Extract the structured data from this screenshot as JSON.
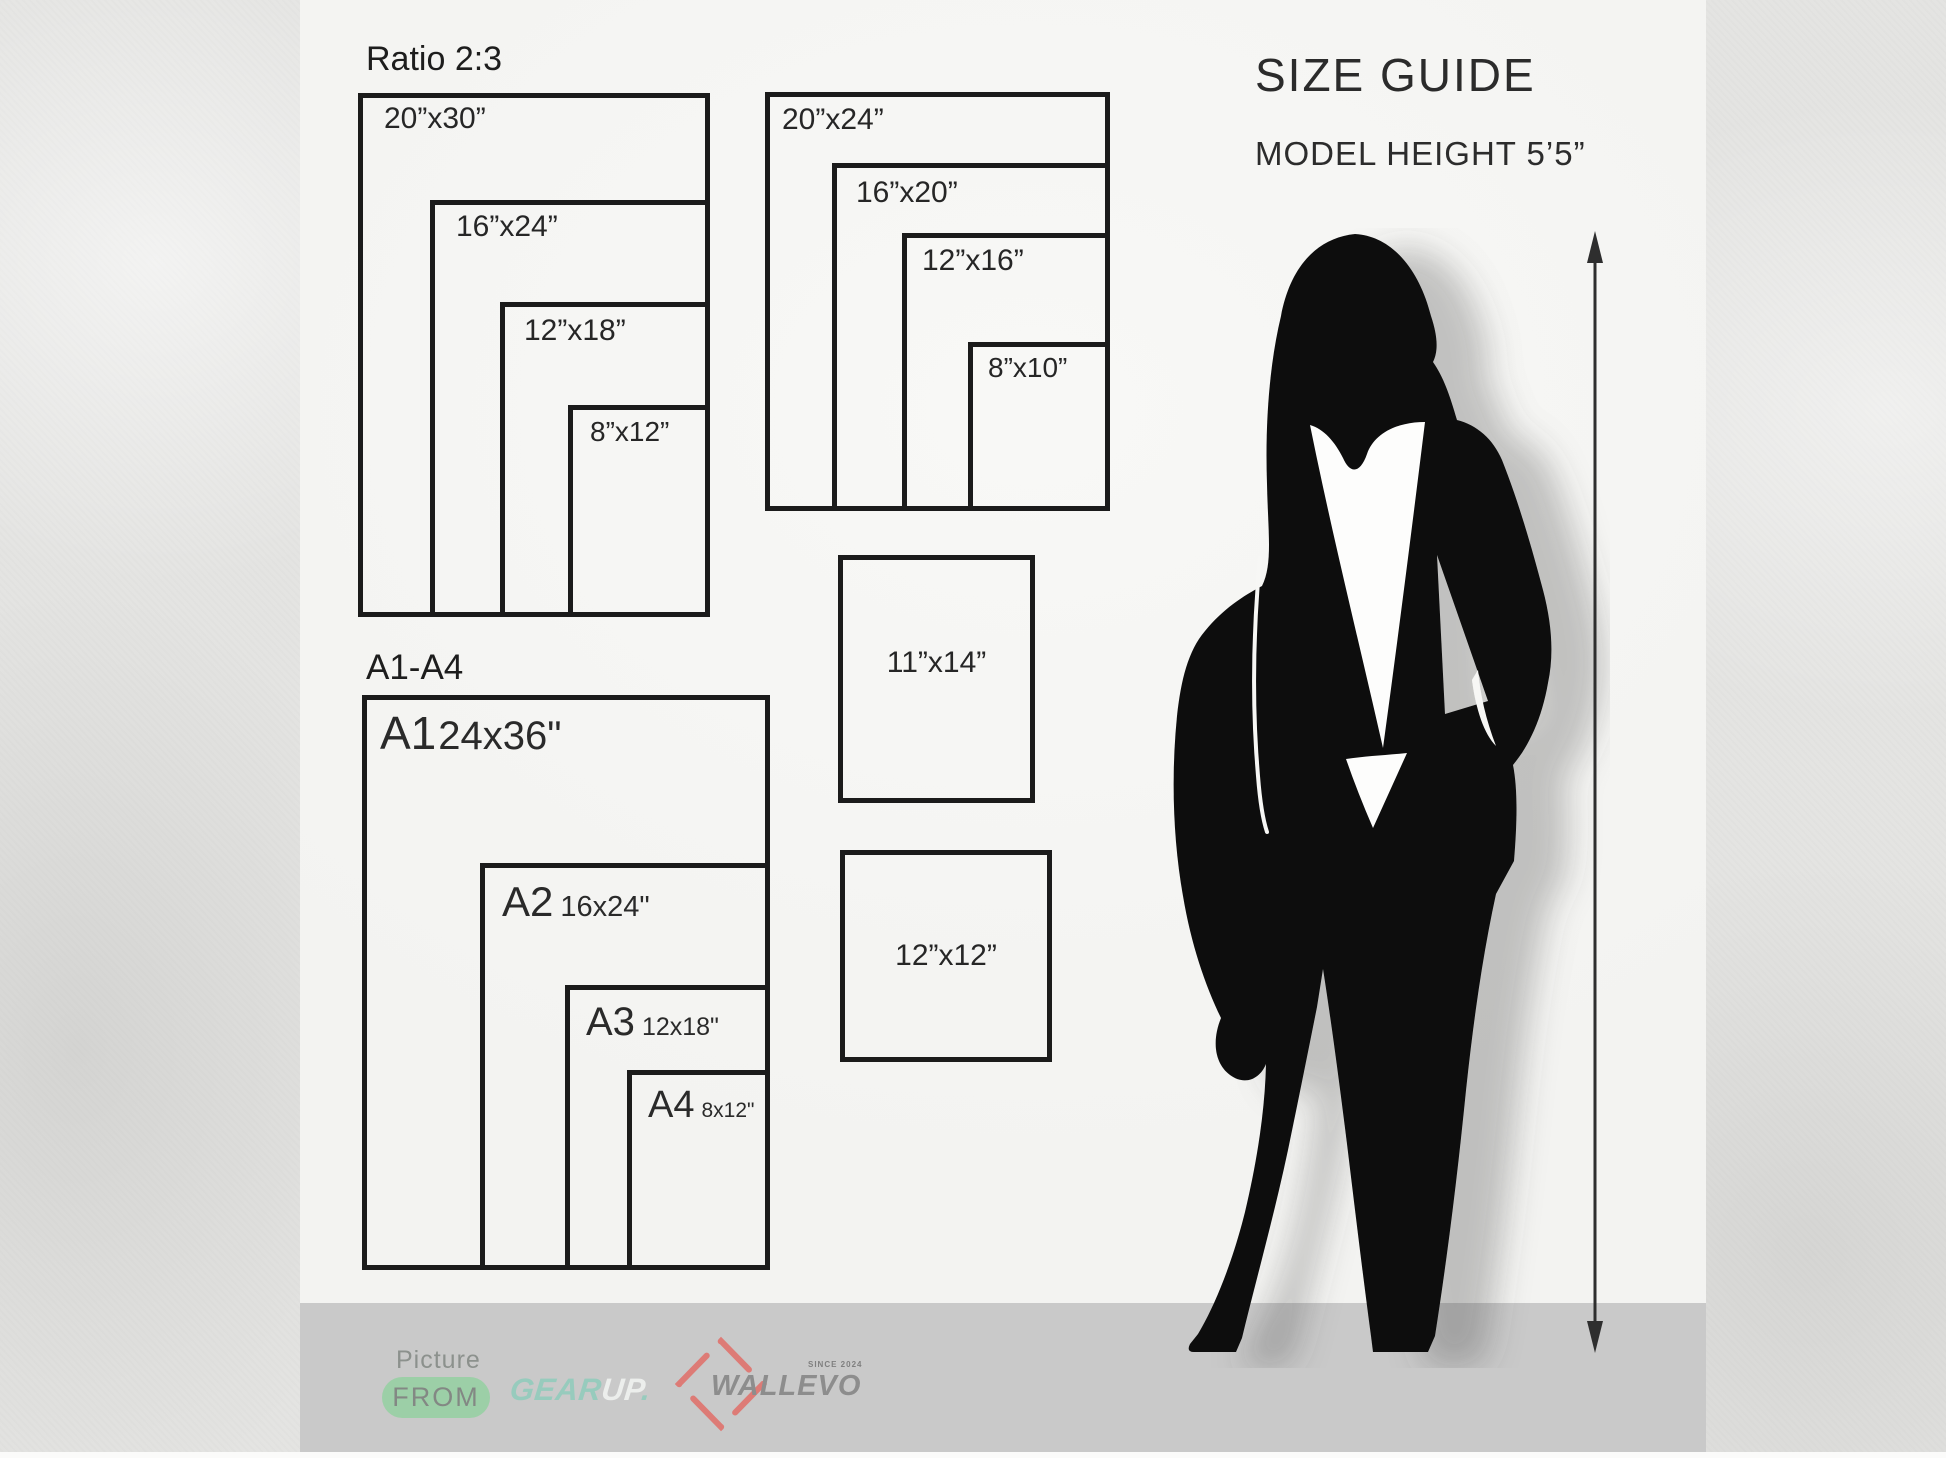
{
  "ratio_group": {
    "title": "Ratio 2:3",
    "sizes": [
      "20”x30”",
      "16”x24”",
      "12”x18”",
      "8”x12”"
    ]
  },
  "standard_group": {
    "sizes": [
      "20”x24”",
      "16”x20”",
      "12”x16”",
      "8”x10”"
    ]
  },
  "single_frames": [
    "11”x14”",
    "12”x12”"
  ],
  "a_group": {
    "title": "A1-A4",
    "items": [
      {
        "name": "A1",
        "size": "24x36\""
      },
      {
        "name": "A2",
        "size": "16x24\""
      },
      {
        "name": "A3",
        "size": "12x18\""
      },
      {
        "name": "A4",
        "size": "8x12\""
      }
    ]
  },
  "size_guide": {
    "title": "SIZE GUIDE",
    "model_height": "MODEL HEIGHT 5’5”"
  },
  "branding": {
    "picture_label": "Picture",
    "from_label": "FROM",
    "gear_label": "GEAR",
    "up_label": "UP",
    "gearup_dot": ".",
    "wallevo_label": "WALLEVO",
    "since_label": "SINCE 2024"
  },
  "icons": {
    "measure_arrow": "double-headed-vertical-arrow",
    "wallevo_diamond": "diamond-outline",
    "model_silhouette": "woman-silhouette"
  },
  "colors": {
    "background": "#e4e4e2",
    "panel": "#f5f5f3",
    "bottom_bar": "#c9c9c9",
    "frame_border": "#1b1b1b",
    "silhouette": "#0d0d0d",
    "accent_green_pill": "#9ccfa7",
    "accent_mint": "#97cbbd",
    "accent_white": "#eceeec",
    "accent_salmon": "#dd7b76",
    "logo_gray": "#8d8d8d"
  }
}
